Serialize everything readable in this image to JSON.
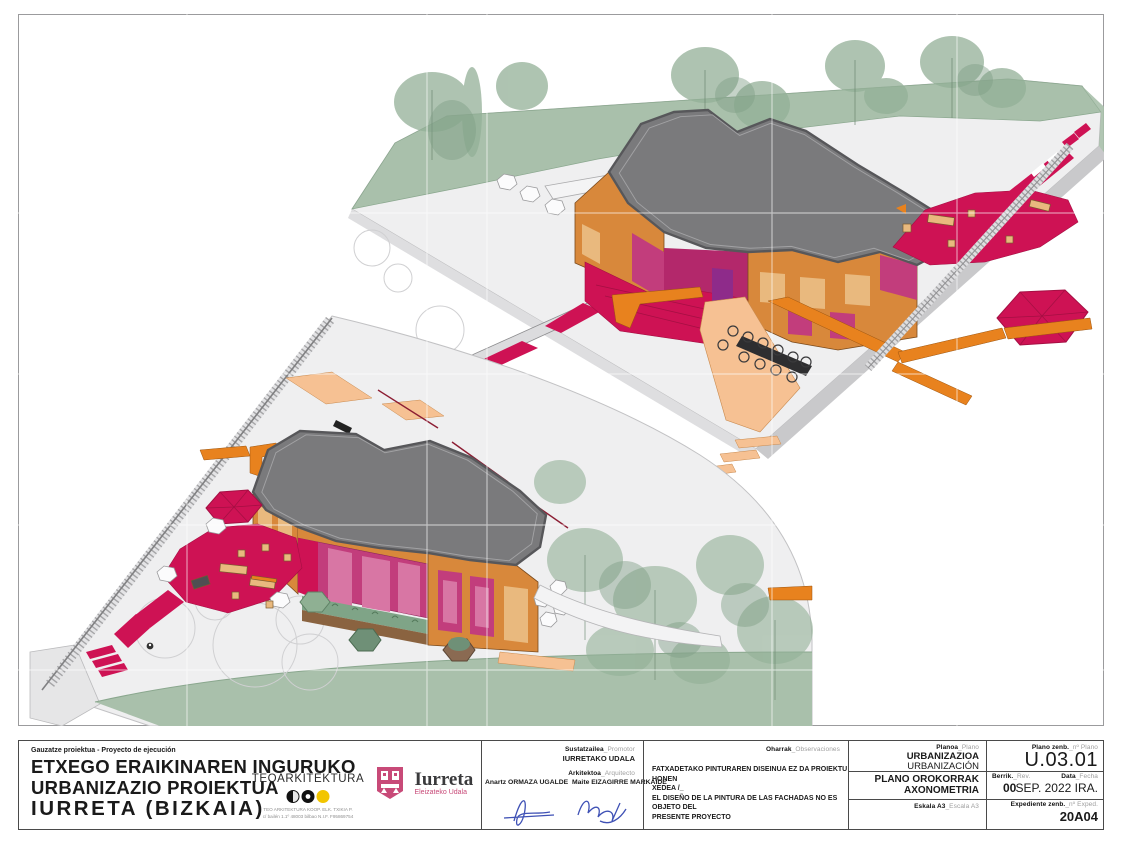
{
  "project": {
    "kicker": "Gauzatze proiektua - Proyecto de ejecución",
    "title_line1": "ETXEGO ERAIKINAREN INGURUKO",
    "title_line2": "URBANIZAZIO PROIEKTUA",
    "title_line3": "IURRETA (BIZKAIA)"
  },
  "teo": {
    "name": "TEOARKITEKTURA",
    "sub1": "TEO ARKITEKTURA KOOP. ELK. TXIKIA P.",
    "sub2": "c/ bailén 1.1º  48003 bilbao   N.I.F. F95869754"
  },
  "iurreta": {
    "name": "Iurreta",
    "sub": "Eleizateko Udala"
  },
  "promotor": {
    "label_eu": "Sustatzailea",
    "label_es": "_Promotor",
    "value": "IURRETAKO UDALA",
    "architect_label_eu": "Arkitektoa",
    "architect_label_es": "_Arquitecto",
    "architect_name1": "Anartz ORMAZA UGALDE",
    "architect_name2": "Maite EIZAGIRRE MARKAIDE"
  },
  "remarks": {
    "label_eu": "Oharrak",
    "label_es": "_Observaciones",
    "line1": "FATXADETAKO PINTURAREN DISEINUA EZ DA PROIEKTU HONEN",
    "line2": "XEDEA /_",
    "line3": "EL DISEÑO DE LA PINTURA DE LAS FACHADAS NO ES OBJETO DEL",
    "line4": "PRESENTE PROYECTO"
  },
  "plano": {
    "label_eu": "Planoa",
    "label_es": "_Plano",
    "line1": "URBANIZAZIOA",
    "line2": "URBANIZACIÓN",
    "line3": "PLANO OROKORRAK",
    "line4": "AXONOMETRIA",
    "scale_eu": "Eskala A3",
    "scale_es": "_Escala A3"
  },
  "numbering": {
    "plan_no_label_eu": "Plano zenb.",
    "plan_no_label_es": "_nº Plano",
    "plan_no": "U.03.01",
    "rev_label_eu": "Berrik.",
    "rev_label_es": "_Rev.",
    "rev": "00",
    "date_label_eu": "Data",
    "date_label_es": "_Fecha",
    "date": "SEP. 2022 IRA.",
    "exp_label_eu": "Expediente zenb.",
    "exp_label_es": "_nº Exped.",
    "exp": "20A04"
  },
  "palette": {
    "plate": "#efeff0",
    "plate-edge": "#c9c9cb",
    "sage": "#a9c0ab",
    "sage-mid": "#93b097",
    "sage-dark": "#7e9e84",
    "roof": "#7a7a7c",
    "roof-dark": "#57575a",
    "roof-light": "#a2a2a4",
    "orange": "#d8883b",
    "orange-path": "#e8821e",
    "peach": "#f6c193",
    "tan": "#e9b97e",
    "crimson": "#ce1254",
    "crimson-dark": "#a50f43",
    "magenta": "#c23d7c",
    "pink": "#d876a4",
    "purple": "#8e2b8a",
    "brown": "#8a6340",
    "plant": "#7fa487",
    "fence": "#e9e9eb",
    "sig-blue": "#3f51b5",
    "iurreta-pink": "#c84a78",
    "teo-yellow": "#f2c500"
  }
}
